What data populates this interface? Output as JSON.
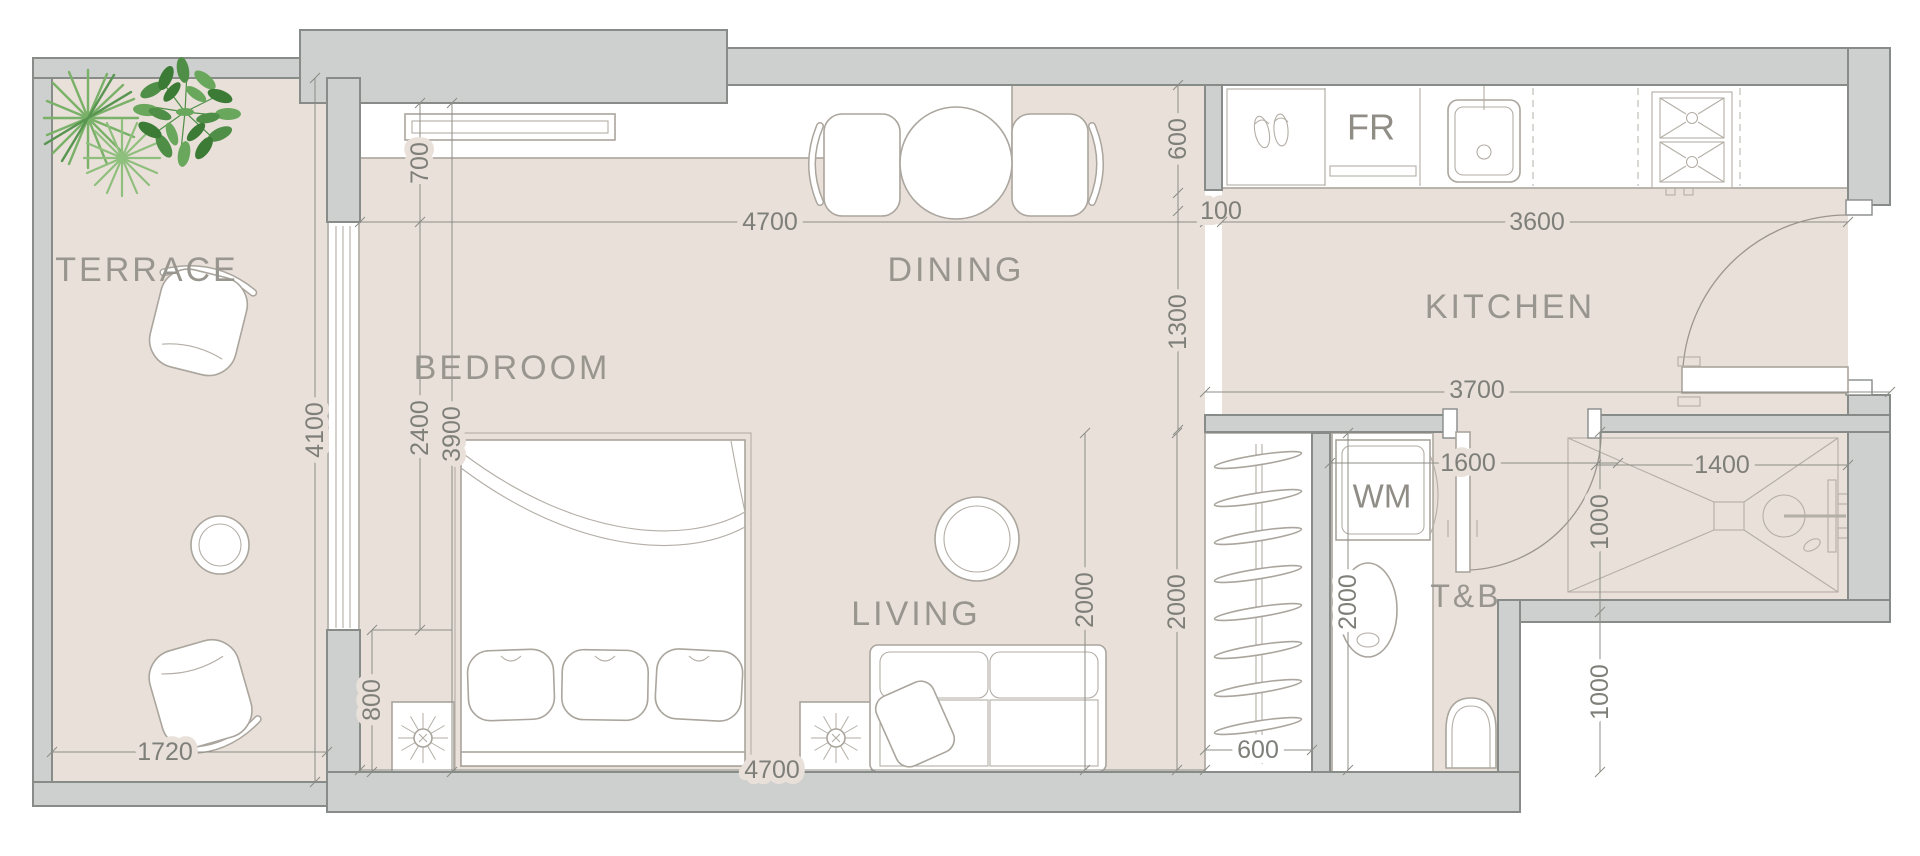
{
  "plan": {
    "title": "Apartment unit floor plan",
    "rooms": {
      "terrace": {
        "label": "TERRACE"
      },
      "bedroom": {
        "label": "BEDROOM"
      },
      "dining": {
        "label": "DINING"
      },
      "kitchen": {
        "label": "KITCHEN"
      },
      "living": {
        "label": "LIVING"
      },
      "toilet_bath": {
        "label": "T&B"
      }
    },
    "appliances": {
      "fridge": "FR",
      "washing_machine": "WM"
    },
    "dimensions_mm": {
      "terrace_width": "1720",
      "terrace_depth": "4100",
      "bedroom_closet_depth": "700",
      "bedroom_window_height": "2400",
      "bedroom_total_depth": "3900",
      "bedroom_side_clearance": "800",
      "bedroom_dining_width": "4700",
      "counter_wall_gap": "100",
      "kitchen_counter_run": "3600",
      "kitchen_counter_depth": "600",
      "dining_passage_depth": "1300",
      "kitchen_total_width": "3700",
      "living_bottom_width": "4700",
      "living_depth": "2000",
      "wardrobe_depth": "2000",
      "wardrobe_width": "600",
      "utility_nook_width": "1600",
      "utility_depth": "2000",
      "tb_door_clearance": "1000",
      "tb_lower_depth": "1000",
      "shower_width": "1400"
    },
    "colors": {
      "floor": "#e9e0da",
      "wall_fill": "#cdd0ce",
      "wall_stroke": "#878c89",
      "furniture_stroke": "#aaa59d",
      "dimension_text": "#7f7f79",
      "room_text": "#98968e",
      "plant_green_light": "#8fbf7d",
      "plant_green": "#7ab168",
      "plant_green_dark": "#4f8e46"
    }
  }
}
